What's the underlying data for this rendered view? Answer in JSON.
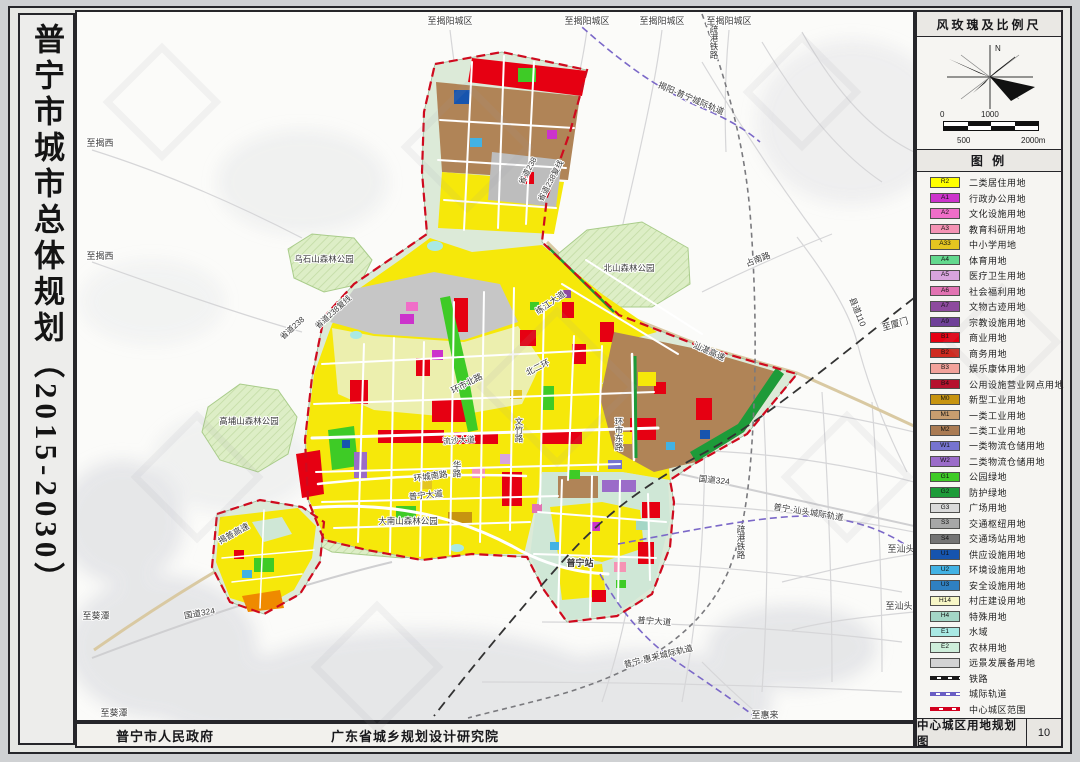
{
  "title": {
    "vertical_text": "普宁市城市总体规划（2015-2030）"
  },
  "footer": {
    "left_org": "普宁市人民政府",
    "right_org": "广东省城乡规划设计研究院"
  },
  "panel": {
    "windrose_header": "风玫瑰及比例尺",
    "north_label": "N",
    "scale_labels": {
      "zero": "0",
      "thousand": "1000",
      "five_hundred": "500",
      "two_thousand": "2000m"
    },
    "legend_header": "图  例",
    "legend_items": [
      {
        "code": "R2",
        "label": "二类居住用地",
        "color": "#ffff00"
      },
      {
        "code": "A1",
        "label": "行政办公用地",
        "color": "#cc33cc"
      },
      {
        "code": "A2",
        "label": "文化设施用地",
        "color": "#f06ec8"
      },
      {
        "code": "A3",
        "label": "教育科研用地",
        "color": "#f593b4"
      },
      {
        "code": "A33",
        "label": "中小学用地",
        "color": "#e4c520"
      },
      {
        "code": "A4",
        "label": "体育用地",
        "color": "#62d98e"
      },
      {
        "code": "A5",
        "label": "医疗卫生用地",
        "color": "#d8a4de"
      },
      {
        "code": "A6",
        "label": "社会福利用地",
        "color": "#e273b2"
      },
      {
        "code": "A7",
        "label": "文物古迹用地",
        "color": "#8d4a9e"
      },
      {
        "code": "A9",
        "label": "宗教设施用地",
        "color": "#6f4098"
      },
      {
        "code": "B1",
        "label": "商业用地",
        "color": "#e60012"
      },
      {
        "code": "B2",
        "label": "商务用地",
        "color": "#cf2b20"
      },
      {
        "code": "B3",
        "label": "娱乐康体用地",
        "color": "#f2a29a"
      },
      {
        "code": "B4",
        "label": "公用设施营业网点用地",
        "color": "#b5122e"
      },
      {
        "code": "M0",
        "label": "新型工业用地",
        "color": "#c79410"
      },
      {
        "code": "M1",
        "label": "一类工业用地",
        "color": "#c89d6f"
      },
      {
        "code": "M2",
        "label": "二类工业用地",
        "color": "#aa7b53"
      },
      {
        "code": "W1",
        "label": "一类物流仓储用地",
        "color": "#7674d0"
      },
      {
        "code": "W2",
        "label": "二类物流仓储用地",
        "color": "#9b6cc9"
      },
      {
        "code": "G1",
        "label": "公园绿地",
        "color": "#3ecb26"
      },
      {
        "code": "G2",
        "label": "防护绿地",
        "color": "#1d9b39"
      },
      {
        "code": "G3",
        "label": "广场用地",
        "color": "#dadada"
      },
      {
        "code": "S3",
        "label": "交通枢纽用地",
        "color": "#a7a7a7"
      },
      {
        "code": "S4",
        "label": "交通场站用地",
        "color": "#747474"
      },
      {
        "code": "U1",
        "label": "供应设施用地",
        "color": "#1654ae"
      },
      {
        "code": "U2",
        "label": "环境设施用地",
        "color": "#42b2e4"
      },
      {
        "code": "U3",
        "label": "安全设施用地",
        "color": "#2f80c1"
      },
      {
        "code": "H14",
        "label": "村庄建设用地",
        "color": "#f7f6c6"
      },
      {
        "code": "H4",
        "label": "特殊用地",
        "color": "#a4d6c6"
      },
      {
        "code": "E1",
        "label": "水域",
        "color": "#a9e9e4"
      },
      {
        "code": "E2",
        "label": "农林用地",
        "color": "#ceeeda"
      },
      {
        "code": "",
        "label": "远景发展备用地",
        "color": "#d3d3d3"
      },
      {
        "label": "铁路",
        "line": "rail"
      },
      {
        "label": "城际轨道",
        "line": "metro"
      },
      {
        "label": "中心城区范围",
        "line": "boundary"
      }
    ],
    "sheet_title": "中心城区用地规划图",
    "sheet_number": "10"
  },
  "map": {
    "labels": [
      {
        "t": "至揭阳城区",
        "x": 448,
        "y": 22
      },
      {
        "t": "至揭阳城区",
        "x": 585,
        "y": 22
      },
      {
        "t": "至揭阳城区",
        "x": 660,
        "y": 22
      },
      {
        "t": "至揭阳城区",
        "x": 727,
        "y": 22
      },
      {
        "t": "疏港铁路",
        "x": 712,
        "y": 40,
        "v": 1,
        "s": 8.5
      },
      {
        "t": "揭阳-普宁城际轨道",
        "x": 688,
        "y": 99,
        "r": 23,
        "s": 8.5
      },
      {
        "t": "至揭西",
        "x": 98,
        "y": 144
      },
      {
        "t": "至揭西",
        "x": 98,
        "y": 257
      },
      {
        "t": "乌石山森林公园",
        "x": 322,
        "y": 260,
        "c": "#55663f",
        "s": 8.5
      },
      {
        "t": "北山森林公园",
        "x": 627,
        "y": 269,
        "c": "#55663f",
        "s": 8.5
      },
      {
        "t": "高埔山森林公园",
        "x": 247,
        "y": 422,
        "c": "#55663f",
        "s": 8.5
      },
      {
        "t": "大南山森林公园",
        "x": 406,
        "y": 522,
        "c": "#55663f",
        "s": 8.5
      },
      {
        "t": "省道238",
        "x": 528,
        "y": 170,
        "r": -62,
        "s": 8
      },
      {
        "t": "省道238复线",
        "x": 551,
        "y": 180,
        "r": -62,
        "s": 8
      },
      {
        "t": "省道238复线",
        "x": 333,
        "y": 312,
        "r": -42,
        "s": 8
      },
      {
        "t": "省道238",
        "x": 292,
        "y": 328,
        "r": -42,
        "s": 8
      },
      {
        "t": "占南路",
        "x": 757,
        "y": 260,
        "r": -21,
        "s": 8.5
      },
      {
        "t": "县道110",
        "x": 853,
        "y": 311,
        "r": 68,
        "s": 8.5
      },
      {
        "t": "至厦门",
        "x": 894,
        "y": 325,
        "r": -16
      },
      {
        "t": "练江大道",
        "x": 550,
        "y": 303,
        "r": -35,
        "s": 8.5
      },
      {
        "t": "汕湛高速",
        "x": 706,
        "y": 352,
        "r": 24,
        "s": 8.5
      },
      {
        "t": "环市北路",
        "x": 466,
        "y": 384,
        "r": -27,
        "s": 8.5
      },
      {
        "t": "北二环",
        "x": 537,
        "y": 368,
        "r": -27,
        "s": 8.5
      },
      {
        "t": "文竹路",
        "x": 517,
        "y": 428,
        "v": 1,
        "s": 8.5
      },
      {
        "t": "环市东路",
        "x": 617,
        "y": 432,
        "v": 1,
        "s": 8.5
      },
      {
        "t": "华路",
        "x": 455,
        "y": 467,
        "v": 1,
        "s": 8.5
      },
      {
        "t": "流沙大道",
        "x": 457,
        "y": 441,
        "r": -4,
        "s": 8,
        "c": "#8f1717"
      },
      {
        "t": "环城南路",
        "x": 429,
        "y": 477,
        "r": -8,
        "s": 8.5
      },
      {
        "t": "普宁大道",
        "x": 424,
        "y": 496,
        "r": -6,
        "s": 8.5
      },
      {
        "t": "揭普高速",
        "x": 233,
        "y": 534,
        "r": -29,
        "s": 8.5
      },
      {
        "t": "国道324",
        "x": 198,
        "y": 614,
        "r": -10,
        "s": 8.5
      },
      {
        "t": "国道324",
        "x": 712,
        "y": 481,
        "r": 6,
        "s": 8.5
      },
      {
        "t": "至葵潭",
        "x": 94,
        "y": 617
      },
      {
        "t": "至葵潭",
        "x": 112,
        "y": 714
      },
      {
        "t": "普宁站",
        "x": 578,
        "y": 564,
        "b": 1
      },
      {
        "t": "疏港铁路",
        "x": 739,
        "y": 540,
        "v": 1,
        "s": 8.5
      },
      {
        "t": "普宁-汕头城际轨道",
        "x": 806,
        "y": 513,
        "r": 9,
        "s": 8.5
      },
      {
        "t": "至汕头",
        "x": 899,
        "y": 550
      },
      {
        "t": "至汕头",
        "x": 897,
        "y": 607
      },
      {
        "t": "普宁大道",
        "x": 652,
        "y": 622,
        "r": 4,
        "s": 8.5
      },
      {
        "t": "普宁-惠来城际轨道",
        "x": 657,
        "y": 657,
        "r": -14,
        "s": 8.5
      },
      {
        "t": "至惠来",
        "x": 763,
        "y": 716
      }
    ]
  }
}
